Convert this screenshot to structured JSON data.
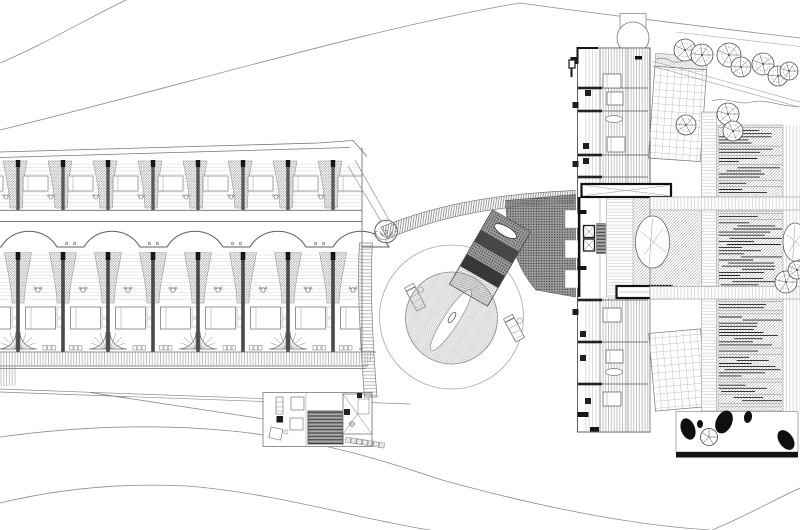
{
  "meta": {
    "title": "Resort site plan – architectural drawing",
    "type": "architectural-site-plan"
  },
  "palette": {
    "paper": "#ffffff",
    "ink": "#4d4d4d",
    "ink_light": "#8a8a8a",
    "ink_faint": "#c9c9c9",
    "black": "#141414",
    "hatch": "#a0a0a0",
    "plaza_bg": "#9b9b9b",
    "plaza_dot": "#1c1c1c",
    "ramp_dark_1": "#474747",
    "ramp_dark_2": "#383838",
    "stair_fill": "#9e9e9e",
    "stair_tread": "#3a3a3a"
  },
  "left_wing": {
    "post_xs": [
      18,
      63,
      108,
      153,
      198,
      243,
      288,
      333
    ],
    "module_width": 45,
    "upper_row": {
      "y": 160,
      "height": 50
    },
    "lower_row": {
      "y": 252,
      "height": 100
    },
    "wave": {
      "baseline_y": 247,
      "peak_y": 226,
      "bump_centers": [
        29,
        112,
        195,
        278,
        361
      ],
      "bump_width": 56,
      "dot_midpoints": [
        70.5,
        153.5,
        236.5,
        319.5
      ]
    },
    "deck_band": {
      "y": 352,
      "height": 14
    }
  },
  "pool": {
    "cx": 451.5,
    "cy": 318,
    "deck_radius": 72,
    "pool_radius": 46,
    "loungers": [
      {
        "x": 416,
        "y": 299,
        "angle": -28
      },
      {
        "x": 515,
        "y": 330,
        "angle": -28
      }
    ]
  },
  "right_building": {
    "upper_divider_ys": [
      88,
      111,
      155,
      177
    ],
    "upper_beds": [
      [
        603,
        74,
        18,
        14
      ],
      [
        607,
        92,
        16,
        13
      ],
      [
        607,
        137,
        18,
        15
      ]
    ],
    "lower_divider_ys": [
      300,
      342,
      384
    ],
    "lower_beds": [
      [
        603,
        308,
        18,
        14
      ],
      [
        606,
        350,
        17,
        13
      ],
      [
        603,
        392,
        18,
        14
      ]
    ],
    "dark_squares": [
      [
        572.5,
        58
      ],
      [
        585,
        90
      ],
      [
        572.5,
        102
      ],
      [
        583,
        143
      ],
      [
        583,
        158
      ],
      [
        572.5,
        161
      ],
      [
        572.5,
        309
      ],
      [
        580,
        331
      ],
      [
        580,
        355
      ],
      [
        585,
        398
      ]
    ],
    "tubs": [
      [
        614,
        119
      ],
      [
        614,
        372
      ]
    ],
    "balconies": [
      [
        565,
        210
      ],
      [
        565,
        240
      ],
      [
        565,
        270
      ]
    ]
  },
  "courtyard": {
    "louver_blocks": [
      [
        718,
        125,
        65,
        72
      ],
      [
        718,
        211,
        65,
        76
      ],
      [
        718,
        299,
        65,
        112
      ]
    ],
    "louver_spacing": 3.1,
    "stone_ellipses": [
      [
        652.5,
        242,
        17,
        26
      ],
      [
        795,
        242,
        12,
        19
      ]
    ]
  },
  "rock_garden": {
    "x": 676,
    "y": 411.5,
    "w": 122,
    "h": 40.5,
    "boulders": [
      [
        688,
        429,
        7,
        11,
        -20
      ],
      [
        724,
        422,
        8,
        12,
        25
      ],
      [
        748,
        417,
        4,
        6,
        10
      ],
      [
        786,
        440,
        7,
        11,
        -35
      ],
      [
        700,
        424,
        3,
        4,
        0
      ]
    ],
    "shrub": [
      709,
      437,
      8.5
    ]
  },
  "trees": [
    [
      685,
      50,
      11
    ],
    [
      702,
      55,
      11
    ],
    [
      729,
      55,
      12
    ],
    [
      741,
      67,
      10
    ],
    [
      763,
      64,
      11
    ],
    [
      778,
      76,
      10
    ],
    [
      789,
      71,
      9
    ],
    [
      686,
      125,
      10
    ],
    [
      728,
      114,
      11
    ],
    [
      733,
      131,
      10
    ],
    [
      786,
      282,
      11
    ],
    [
      797,
      270,
      9
    ]
  ],
  "service": {
    "tile_count": 7,
    "tile_start": [
      346,
      437
    ],
    "tile_step": [
      5.6,
      0.9
    ]
  }
}
